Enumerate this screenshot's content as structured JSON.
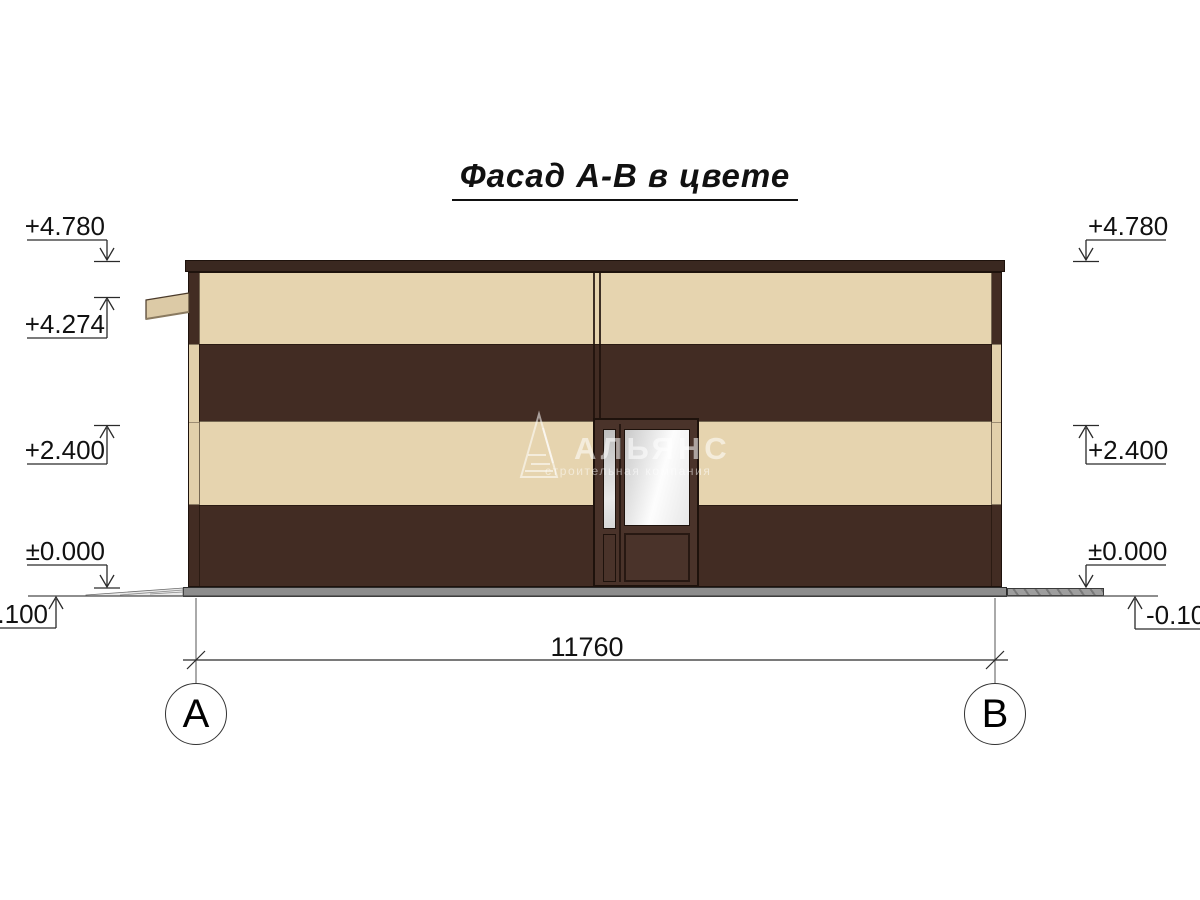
{
  "title": "Фасад А-В в цвете",
  "watermark": {
    "name": "АЛЬЯНС",
    "subtitle": "строительная компания"
  },
  "elevation_markers": {
    "left": [
      {
        "label": "+4.780"
      },
      {
        "label": "+4.274"
      },
      {
        "label": "+2.400"
      },
      {
        "label": "±0.000"
      },
      {
        "label": "-0.100"
      }
    ],
    "right": [
      {
        "label": "+4.780"
      },
      {
        "label": "+2.400"
      },
      {
        "label": "±0.000"
      },
      {
        "label": "-0.100"
      }
    ]
  },
  "dimension": {
    "value": "11760"
  },
  "axes": [
    {
      "label": "А"
    },
    {
      "label": "В"
    }
  ],
  "colors": {
    "brown": "#422c23",
    "brown_dark": "#3a2820",
    "cream": "#e6d4af",
    "cream_dark": "#e2d0ab",
    "door_brown": "#4a332a",
    "outline": "#1e120c",
    "base_gray": "#8d8d8d",
    "ramp_gray": "#9e9e9e",
    "line": "#2a2a2a"
  }
}
